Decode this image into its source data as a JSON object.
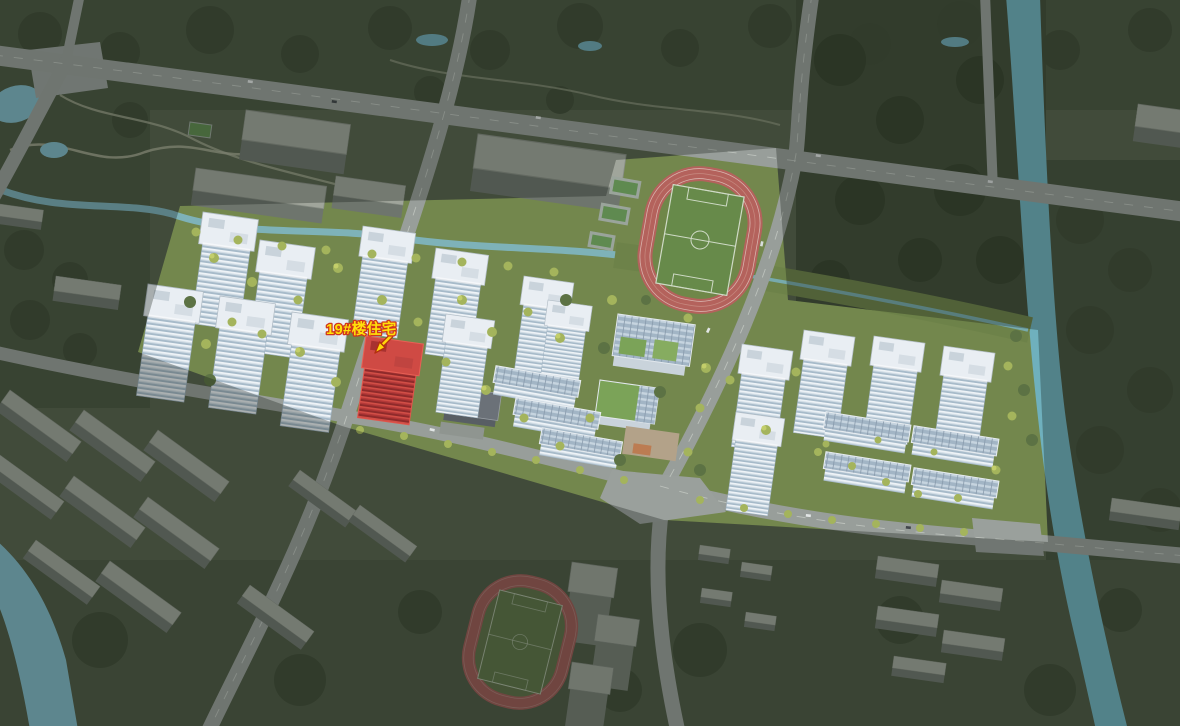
{
  "annotation": {
    "label": "19#楼住宅"
  },
  "palette": {
    "label_yellow": "#ffe10a",
    "label_outline_red": "#d0361c",
    "highlight_red": "#cf4a44",
    "highlight_facade_red": "#b23737",
    "site_green": "#73874d",
    "context_green": "#57624c",
    "forest_green": "#3f4b37",
    "water_teal": "#6fb0bd",
    "road_gray": "#989e9a",
    "track_red": "#b4625c",
    "tower_white": "#e9eef3",
    "context_building_gray": "#a0a59b"
  }
}
